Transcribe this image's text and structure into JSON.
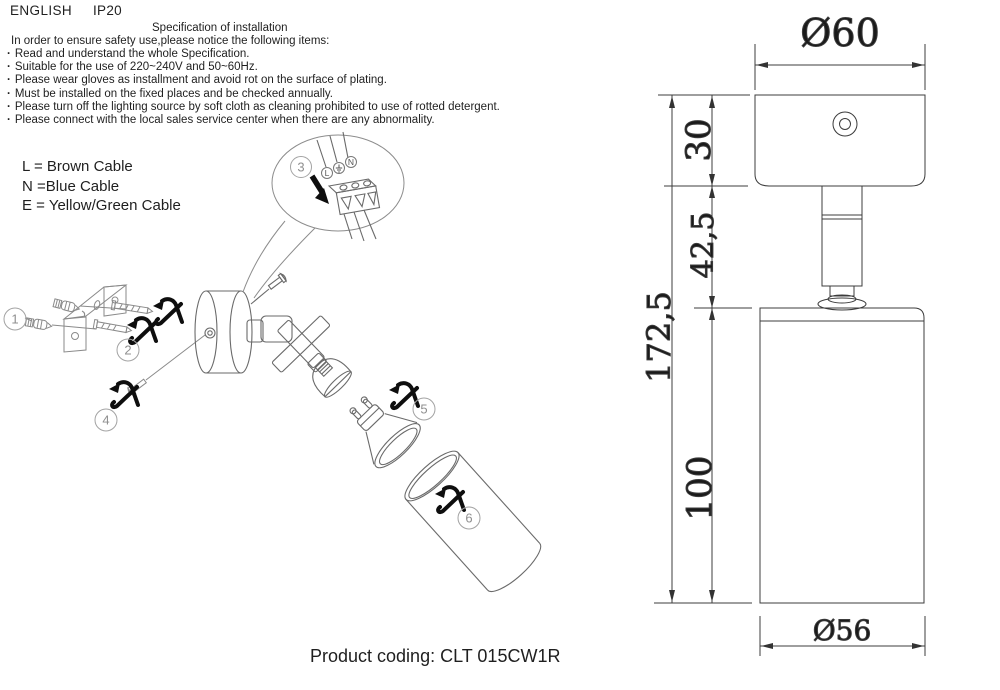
{
  "header": {
    "language": "ENGLISH",
    "ip_rating": "IP20"
  },
  "spec": {
    "title": "Specification of installation",
    "intro": "In order to ensure safety use,please notice the following items:",
    "items": [
      "Read and understand the whole Specification.",
      "Suitable for the use of 220~240V and 50~60Hz.",
      "Please wear gloves as installment and avoid rot on the surface of plating.",
      "Must be installed on the fixed places and be checked annually.",
      "Please turn off the lighting source by soft cloth as cleaning prohibited to use of rotted detergent.",
      "Please connect with the local sales service center when there are any abnormality."
    ]
  },
  "cable_legend": {
    "l": "L = Brown Cable",
    "n": "N =Blue Cable",
    "e": "E = Yellow/Green Cable"
  },
  "wiring_detail": {
    "terminal_live": "L",
    "terminal_neutral": "N",
    "earth_icon": "earth-ground-symbol"
  },
  "balloons": {
    "b1": "1",
    "b2": "2",
    "b3": "3",
    "b4": "4",
    "b5": "5",
    "b6": "6"
  },
  "dimensions": {
    "canopy_diameter": "Ø60",
    "canopy_height": "30",
    "stem_section": "42,5",
    "overall_height": "172,5",
    "shade_height": "100",
    "shade_diameter": "Ø56"
  },
  "footer": {
    "product_coding": "Product coding: CLT 015CW1R"
  },
  "colors": {
    "background": "#ffffff",
    "ink": "#1f1f1f",
    "drawing_line": "#6a6a6a",
    "dimension_line": "#3c3c3c",
    "balloon_line": "#a3a3a3",
    "action_black": "#0e0e0e"
  }
}
